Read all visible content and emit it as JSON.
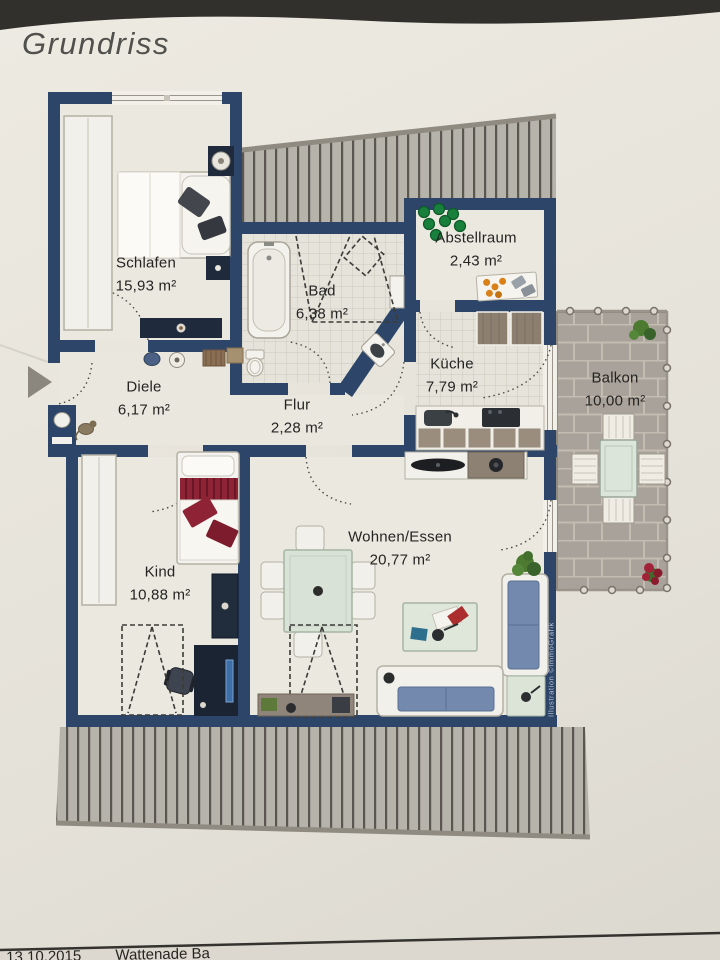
{
  "title": "Grundriss",
  "rooms": [
    {
      "name": "Schlafen",
      "area": "15,93 m²"
    },
    {
      "name": "Bad",
      "area": "6,38 m²"
    },
    {
      "name": "Abstellraum",
      "area": "2,43 m²"
    },
    {
      "name": "Küche",
      "area": "7,79 m²"
    },
    {
      "name": "Balkon",
      "area": "10,00 m²"
    },
    {
      "name": "Diele",
      "area": "6,17 m²"
    },
    {
      "name": "Flur",
      "area": "2,28 m²"
    },
    {
      "name": "Kind",
      "area": "10,88 m²"
    },
    {
      "name": "Wohnen/Essen",
      "area": "20,77 m²"
    }
  ],
  "watermark": "Illustration ©ImmoGrafik",
  "footer": {
    "date": "13.10.2015",
    "note": "Wattenade Ba"
  },
  "furniture_icons": [
    "double-bed",
    "wardrobe",
    "nightstand",
    "bathtub",
    "washbasin",
    "toilet",
    "shelf",
    "kitchen-cabinets",
    "kitchen-counter",
    "sink",
    "stove",
    "storage-box",
    "bottles",
    "single-bed",
    "desk",
    "desk-chair",
    "dresser",
    "dining-table",
    "dining-chair",
    "tv-bench",
    "speaker",
    "sofa",
    "coffee-table",
    "side-table",
    "sideboard",
    "plant",
    "balcony-table",
    "balcony-chair",
    "entrance-arrow",
    "pet"
  ],
  "colors": {
    "paper": "#e8e5dc",
    "wall": "#2c4569",
    "roof_hatch": "#b6b3ab",
    "tile_grid": "#ccc9bf",
    "balcony_paving": "#a9a29a",
    "sofa_blue": "#7389ae",
    "bed_red": "#8e2336",
    "plant_green": "#4c7a31",
    "glass_green": "#dce5d9",
    "wood_brown": "#8d7f70"
  }
}
